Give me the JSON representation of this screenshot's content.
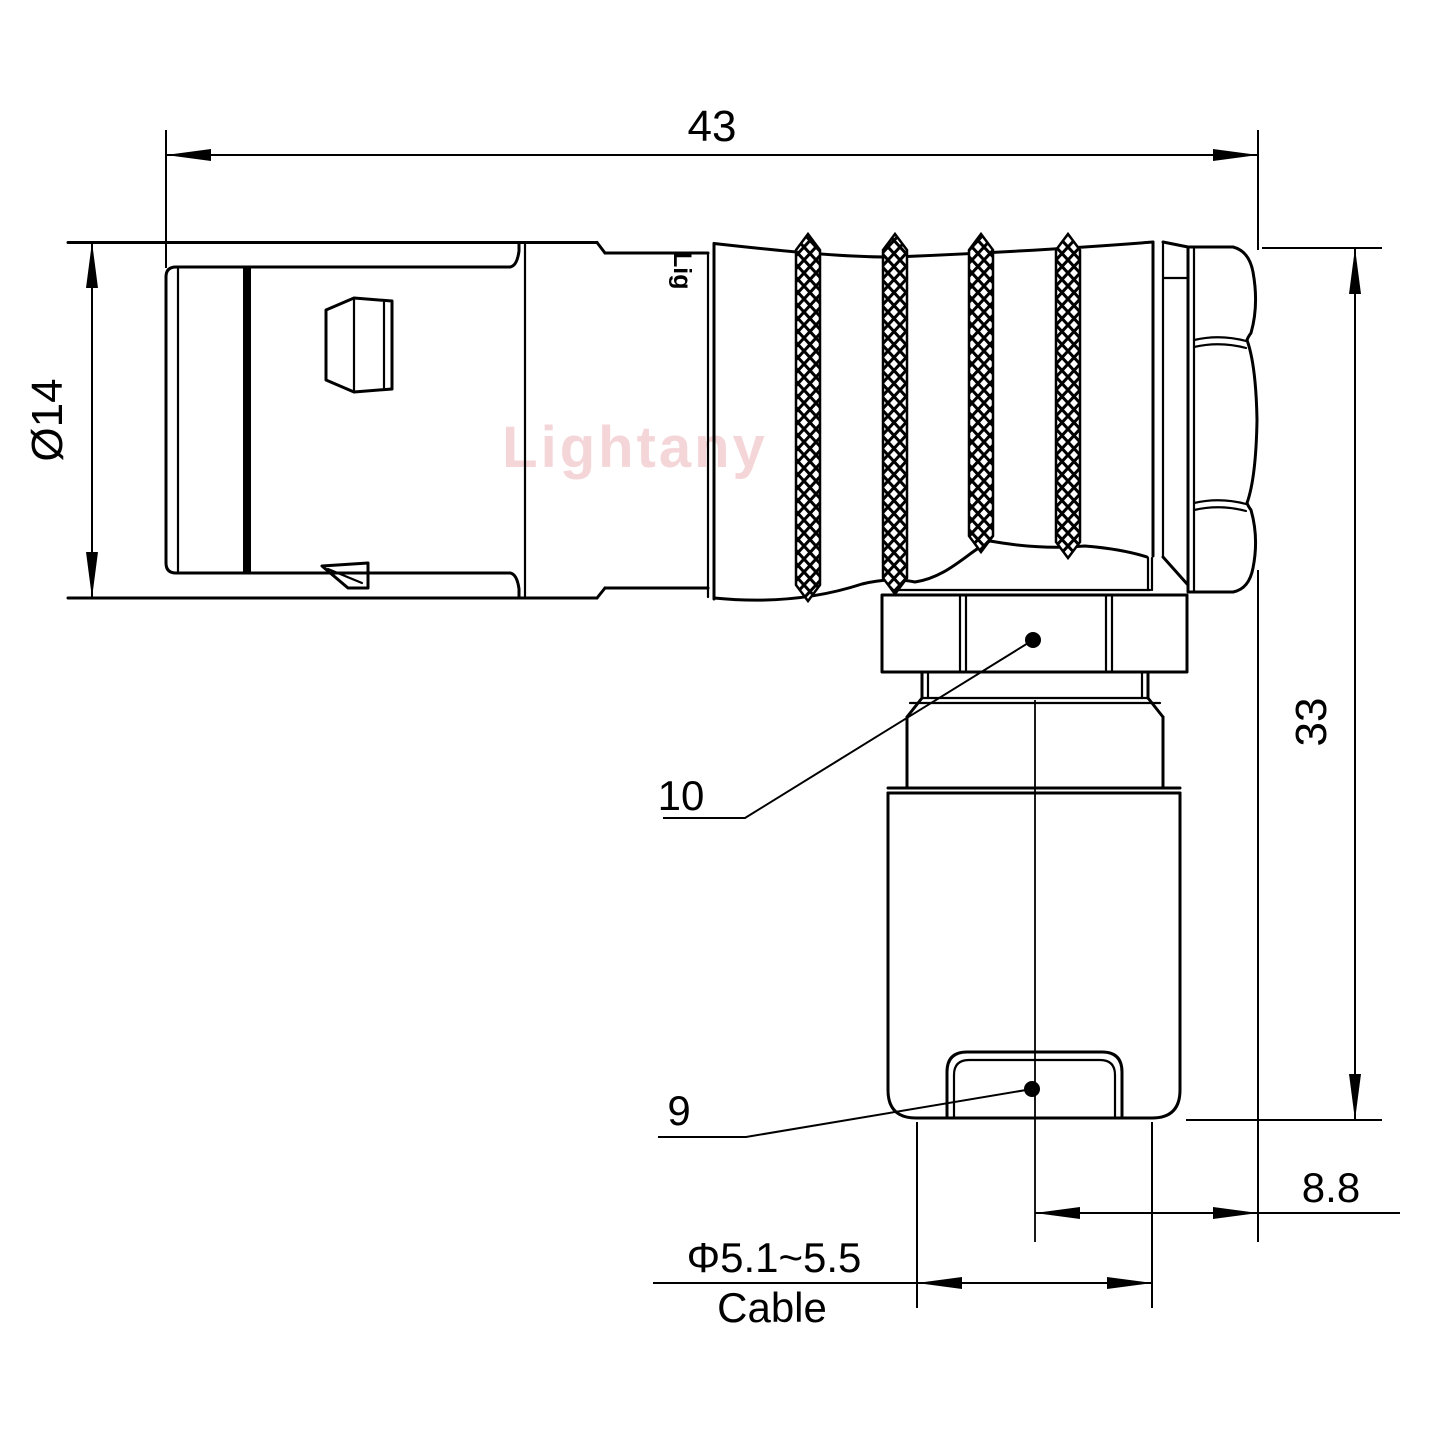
{
  "drawing": {
    "watermark": "Lightany",
    "body_logo": "Lig",
    "dimensions": {
      "overall_length": "43",
      "front_diameter": "Ø14",
      "overall_height": "33",
      "right_offset": "8.8",
      "cable_diameter": "Φ5.1~5.5",
      "cable_word": "Cable"
    },
    "part_labels": {
      "coupling_nut": "10",
      "cable_boot": "9"
    },
    "colors": {
      "line": "#000000",
      "watermark": "#edb5ba",
      "background": "#ffffff"
    }
  }
}
